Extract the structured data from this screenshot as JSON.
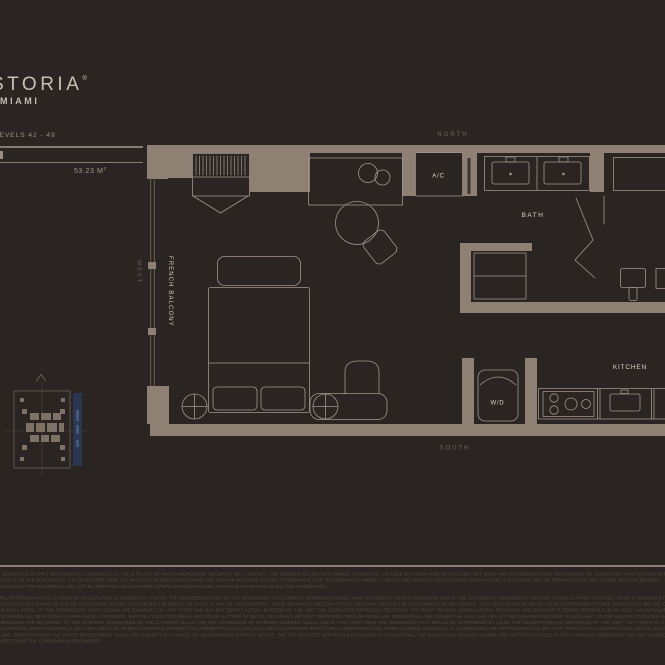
{
  "header": {
    "brand_fragment": "STORIA",
    "brand_reg": "®",
    "brand_city": "MIAMI",
    "levels": "LEVELS 42 - 49",
    "area_value": "53.23 M",
    "area_sup": "2"
  },
  "plan": {
    "compass": {
      "north": "NORTH",
      "south": "SOUTH",
      "west": "WEST"
    },
    "labels": {
      "ac": "A/C",
      "bath": "BATH",
      "kitchen": "KITCHEN",
      "washer_dryer": "W/D",
      "french_balcony": "FRENCH BALCONY"
    },
    "colors": {
      "wall": "#8e8174",
      "line": "#a2958a",
      "room_label": "#ddd5cc",
      "compass_label": "#6f655c",
      "background": "#2a2522",
      "keyplan_highlight": "#2b3750"
    }
  },
  "disclaimer": {
    "para1": "IS DEVELOPED BY PRH INTERNATIONAL HOLDINGS LLC, AN AFFILIATE OF HILTON WORLDWIDE HOLDINGS INC. (\"HILTON\"). THE RESIDENCES ARE NOT OWNED, DEVELOPED, OR SOLD BY HILTON AND HILTON DOES NOT MAKE ANY REPRESENTATIONS, WARRANTIES OR GUARANTIES WHATSOEVER WITH RESPECT TO THE RESIDENCES. THE DEVELOPER USES THE WALDORF ASTORIA BRAND NAME AND CERTAIN WALDORF ASTORIA TRADEMARKS (THE \"TRADEMARKS\") UNDER A LIMITED AND NON-EXCLUSIVE LICENSE FROM HILTON. THE LICENSE MAY BE TERMINATED OR MAY EXPIRE WITHOUT RENEWAL, IN WHICH CASE THE RESIDENCES WILL NOT BE IDENTIFIED AS A WALDORF ASTORIA BRANDED PROJECT OR HAVE ANY RIGHTS TO USE THE TRADEMARKS.",
    "para2": "ORAL REPRESENTATIONS CANNOT BE RELIED UPON AS CORRECTLY STATING THE REPRESENTATIONS OF THE DEVELOPER. FOR CORRECT REPRESENTATIONS, MAKE REFERENCE TO THIS BROCHURE AND TO THE DOCUMENTS REQUIRED BY SECTION 718.503, FLORIDA STATUTES, TO BE FURNISHED BY A DEVELOPER TO A BUYER OR LESSEE. NO FEDERAL AGENCY HAS JUDGED THE MERITS OR VALUE, IF ANY, OF THIS PROPERTY. THESE DRAWINGS ARE CONCEPTUAL ONLY AND ARE FOR THE CONVENIENCE OF REFERENCE. THEY SHOULD NOT BE RELIED UPON AS REPRESENTATIONS, EXPRESS OR IMPLIED, OF THE FINAL DETAIL OF THE RESIDENCES. UNITS SHOWN ARE EXAMPLES OF UNIT TYPES AND MAY NOT DEPICT ACTUAL MATTERS OF THE UNIT. THE DEVELOPER EXPRESSLY RESERVES THE RIGHT TO MAKE MODIFICATIONS, REVISIONS AND CHANGES IT DEEMS DESIRABLE IN ITS SOLE AND ABSOLUTE DISCRETION. ALL DEPICTIONS OF APPLIANCES, COUNTERS, SOFFITS, FLOOR COVERINGS AND OTHER MATTERS OF DETAIL, INCLUDING, WITHOUT LIMITATION, ITEMS OF FINISH AND DECORATION, ARE CONCEPTUAL ONLY AND ARE NOT NECESSARILY INCLUDED IN EACH UNIT. STATED SQUARE FOOTAGES AND DIMENSIONS ARE MEASURED TO THE EXTERIOR BOUNDARIES OF THE EXTERIOR WALLS AND THE CENTERLINE OF INTERIOR DEMISING WALLS AND IN FACT VARY FROM THE DIMENSIONS THAT WOULD BE DETERMINED BY USING THE DESCRIPTION AND DEFINITION OF THE \"UNIT\" SET FORTH IN THE DECLARATION (WHICH GENERALLY ONLY INCLUDES THE INTERIOR AIRSPACE BETWEEN THE PERIMETER WALLS AND EXCLUDES ALL INTERIOR STRUCTURAL COMPONENTS AND OTHER COMMON ELEMENTS). ALL DIMENSIONS ARE APPROXIMATE AND MAY VARY WITH ACTUAL CONSTRUCTION, AND ALL FLOOR PLANS, SPECIFICATIONS AND OTHER DEVELOPMENT PLANS ARE SUBJECT TO CHANGE OR ABANDONMENT WITHOUT NOTICE. THE ART DEPICTED WITHIN THIS DOCUMENT IS CONCEPTUAL. THE IMAGES AND DESIGNS SHOWN ARE FURTHER DETAILED IN THE PURCHASE AGREEMENT AND ANY ADDENDA THERETO AND THE CONDOMINIUM DOCUMENTS."
  }
}
